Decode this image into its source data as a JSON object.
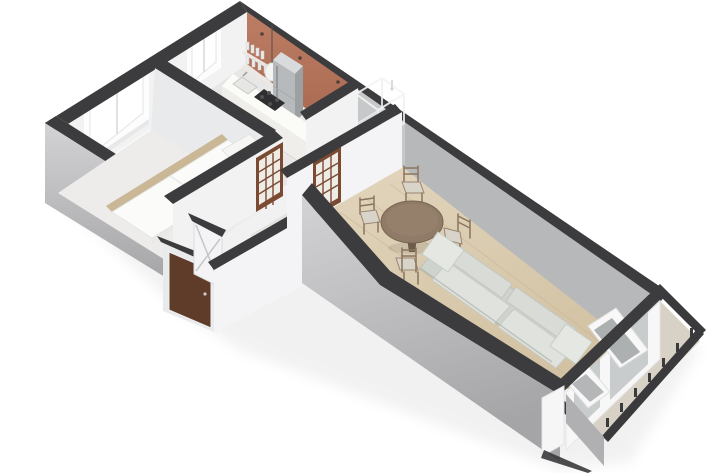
{
  "scene": {
    "type": "isometric-3d-floor-plan",
    "description": "cutaway 3D floor plan of a one-bedroom apartment on a white background",
    "background": "#ffffff"
  },
  "inventory": {
    "rooms": [
      "bedroom",
      "kitchen",
      "bathroom",
      "hallway-vestibule",
      "living-room",
      "balcony"
    ],
    "furniture_and_features": [
      "double-bed",
      "bedroom-windows",
      "kitchen-counter",
      "sink",
      "cooktop",
      "refrigerator",
      "wall-shelves-with-glassware",
      "pendant-lamp",
      "wall-hooks",
      "shower-enclosure",
      "glazed-interior-door-hall",
      "glazed-interior-door-bath",
      "closet-door",
      "entrance-door",
      "round-dining-table",
      "dining-chairs",
      "two-seat-sofa",
      "wood-plank-floor",
      "french-balcony-doors",
      "balcony-railing"
    ],
    "counts": {
      "windows": 2,
      "glazed_interior_doors": 2,
      "dining_chairs": 4,
      "sofa_seats": 2
    }
  },
  "colors": {
    "wall_top": "#3c3c3e",
    "ext_light": "#d3d3d5",
    "ext_dark": "#a5a5a7",
    "int_white": "#f2f2f3",
    "int_bright": "#f6f6f7",
    "int_light": "#e9eaec",
    "int_shaded": "#c6c8ca",
    "int_gray": "#b6b8ba",
    "int_face": "#f4f4f6",
    "terracotta_light": "#bd7d64",
    "terracotta_dark": "#a5654c",
    "floor_bed": "#edecea",
    "floor_trim": "#c9b795",
    "floor_kitchen": "#e8e7e5",
    "floor_hall": "#e5e3df",
    "wood_light": "#e2d6bd",
    "wood_dark": "#d2c1a2",
    "plank": "#c6b496",
    "floor_balcony": "#d8d1c5",
    "bed_white": "#fbfbfa",
    "bed_side": "#e9e9e7",
    "pillow": "#f6f6f4",
    "sofa_base": "#cfd3cd",
    "sofa_cushion": "#d9dcd6",
    "sofa_seat": "#e0e3dd",
    "sofa_arm": "#e4e7e2",
    "table_top": "#8f7b67",
    "table_dark": "#6e5c4a",
    "chair_seat": "#d9d4c9",
    "chair_frame": "#8a7560",
    "door_brown": "#7b4a33",
    "door_pane": "#efece6",
    "door_entry": "#5e3c29",
    "closet": "#f4f4f6",
    "fridge_front": "#b7babc",
    "fridge_side": "#9da0a2",
    "fridge_top": "#d8dadc",
    "counter_top": "#fbfbf8",
    "counter_front": "#efeeea",
    "cooktop": "#2f2f31",
    "win_frame": "#fdfdfd",
    "win_glass": "#ffffff",
    "glass_gray": "#c3c6c8",
    "shower": "#dfe3e5",
    "railing": "#3a3a3c",
    "panel_glass": "#707476",
    "shadow": "#9b9b9b"
  }
}
